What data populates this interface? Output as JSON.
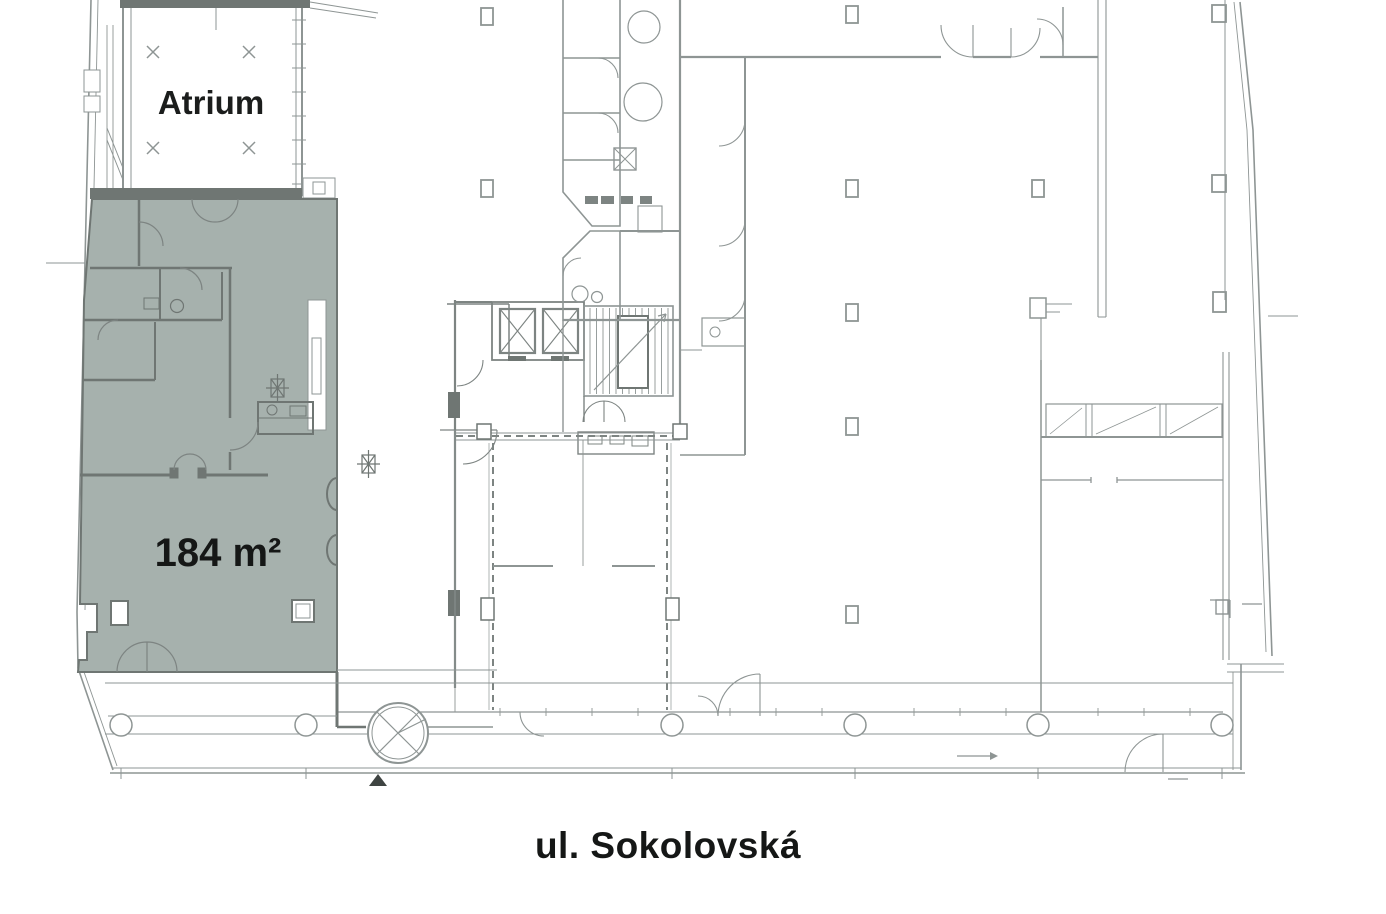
{
  "plan": {
    "labels": {
      "atrium": "Atrium",
      "area": "184 m²",
      "street": "ul. Sokolovská"
    },
    "highlight": {
      "fill": "#a6b1ad",
      "area_value": "184",
      "area_unit": "m²"
    },
    "colors": {
      "wall_light": "#8e9594",
      "wall_medium": "#7d8482",
      "wall_dark": "#6f7673",
      "label_text": "#151716",
      "background": "#ffffff"
    }
  }
}
